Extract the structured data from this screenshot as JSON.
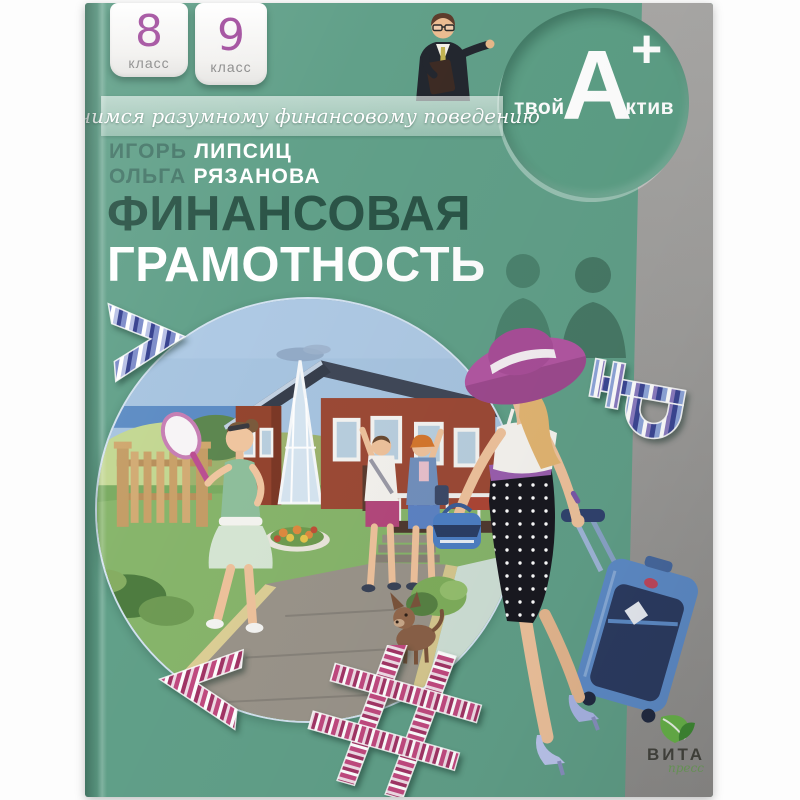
{
  "colors": {
    "cover_green": "#61a089",
    "brand_circle_green": "#5d9f86",
    "title_dark_green": "#2b5447",
    "title_white": "#ffffff",
    "badge_number_purple": "#a3509f",
    "gray_strip": "#a1a09e",
    "author_first_green": "#47786a"
  },
  "badges": [
    {
      "number": "8",
      "label": "класс"
    },
    {
      "number": "9",
      "label": "класс"
    }
  ],
  "ribbon": {
    "text": "Учимся разумному финансовому поведению"
  },
  "authors": [
    {
      "first": "ИГОРЬ",
      "last": "ЛИПСИЦ"
    },
    {
      "first": "ОЛЬГА",
      "last": "РЯЗАНОВА"
    }
  ],
  "title": {
    "line1": "ФИНАНСОВАЯ",
    "line2": "ГРАМОТНОСТЬ"
  },
  "brand": {
    "pre": "твой",
    "letter": "А",
    "plus": "+",
    "post": "ктив"
  },
  "publisher": {
    "name": "ВИТА",
    "sub": "пресс"
  },
  "symbols": {
    "ruble": "₽",
    "hashtag": "#",
    "less_than": "<",
    "chevron": ">"
  }
}
